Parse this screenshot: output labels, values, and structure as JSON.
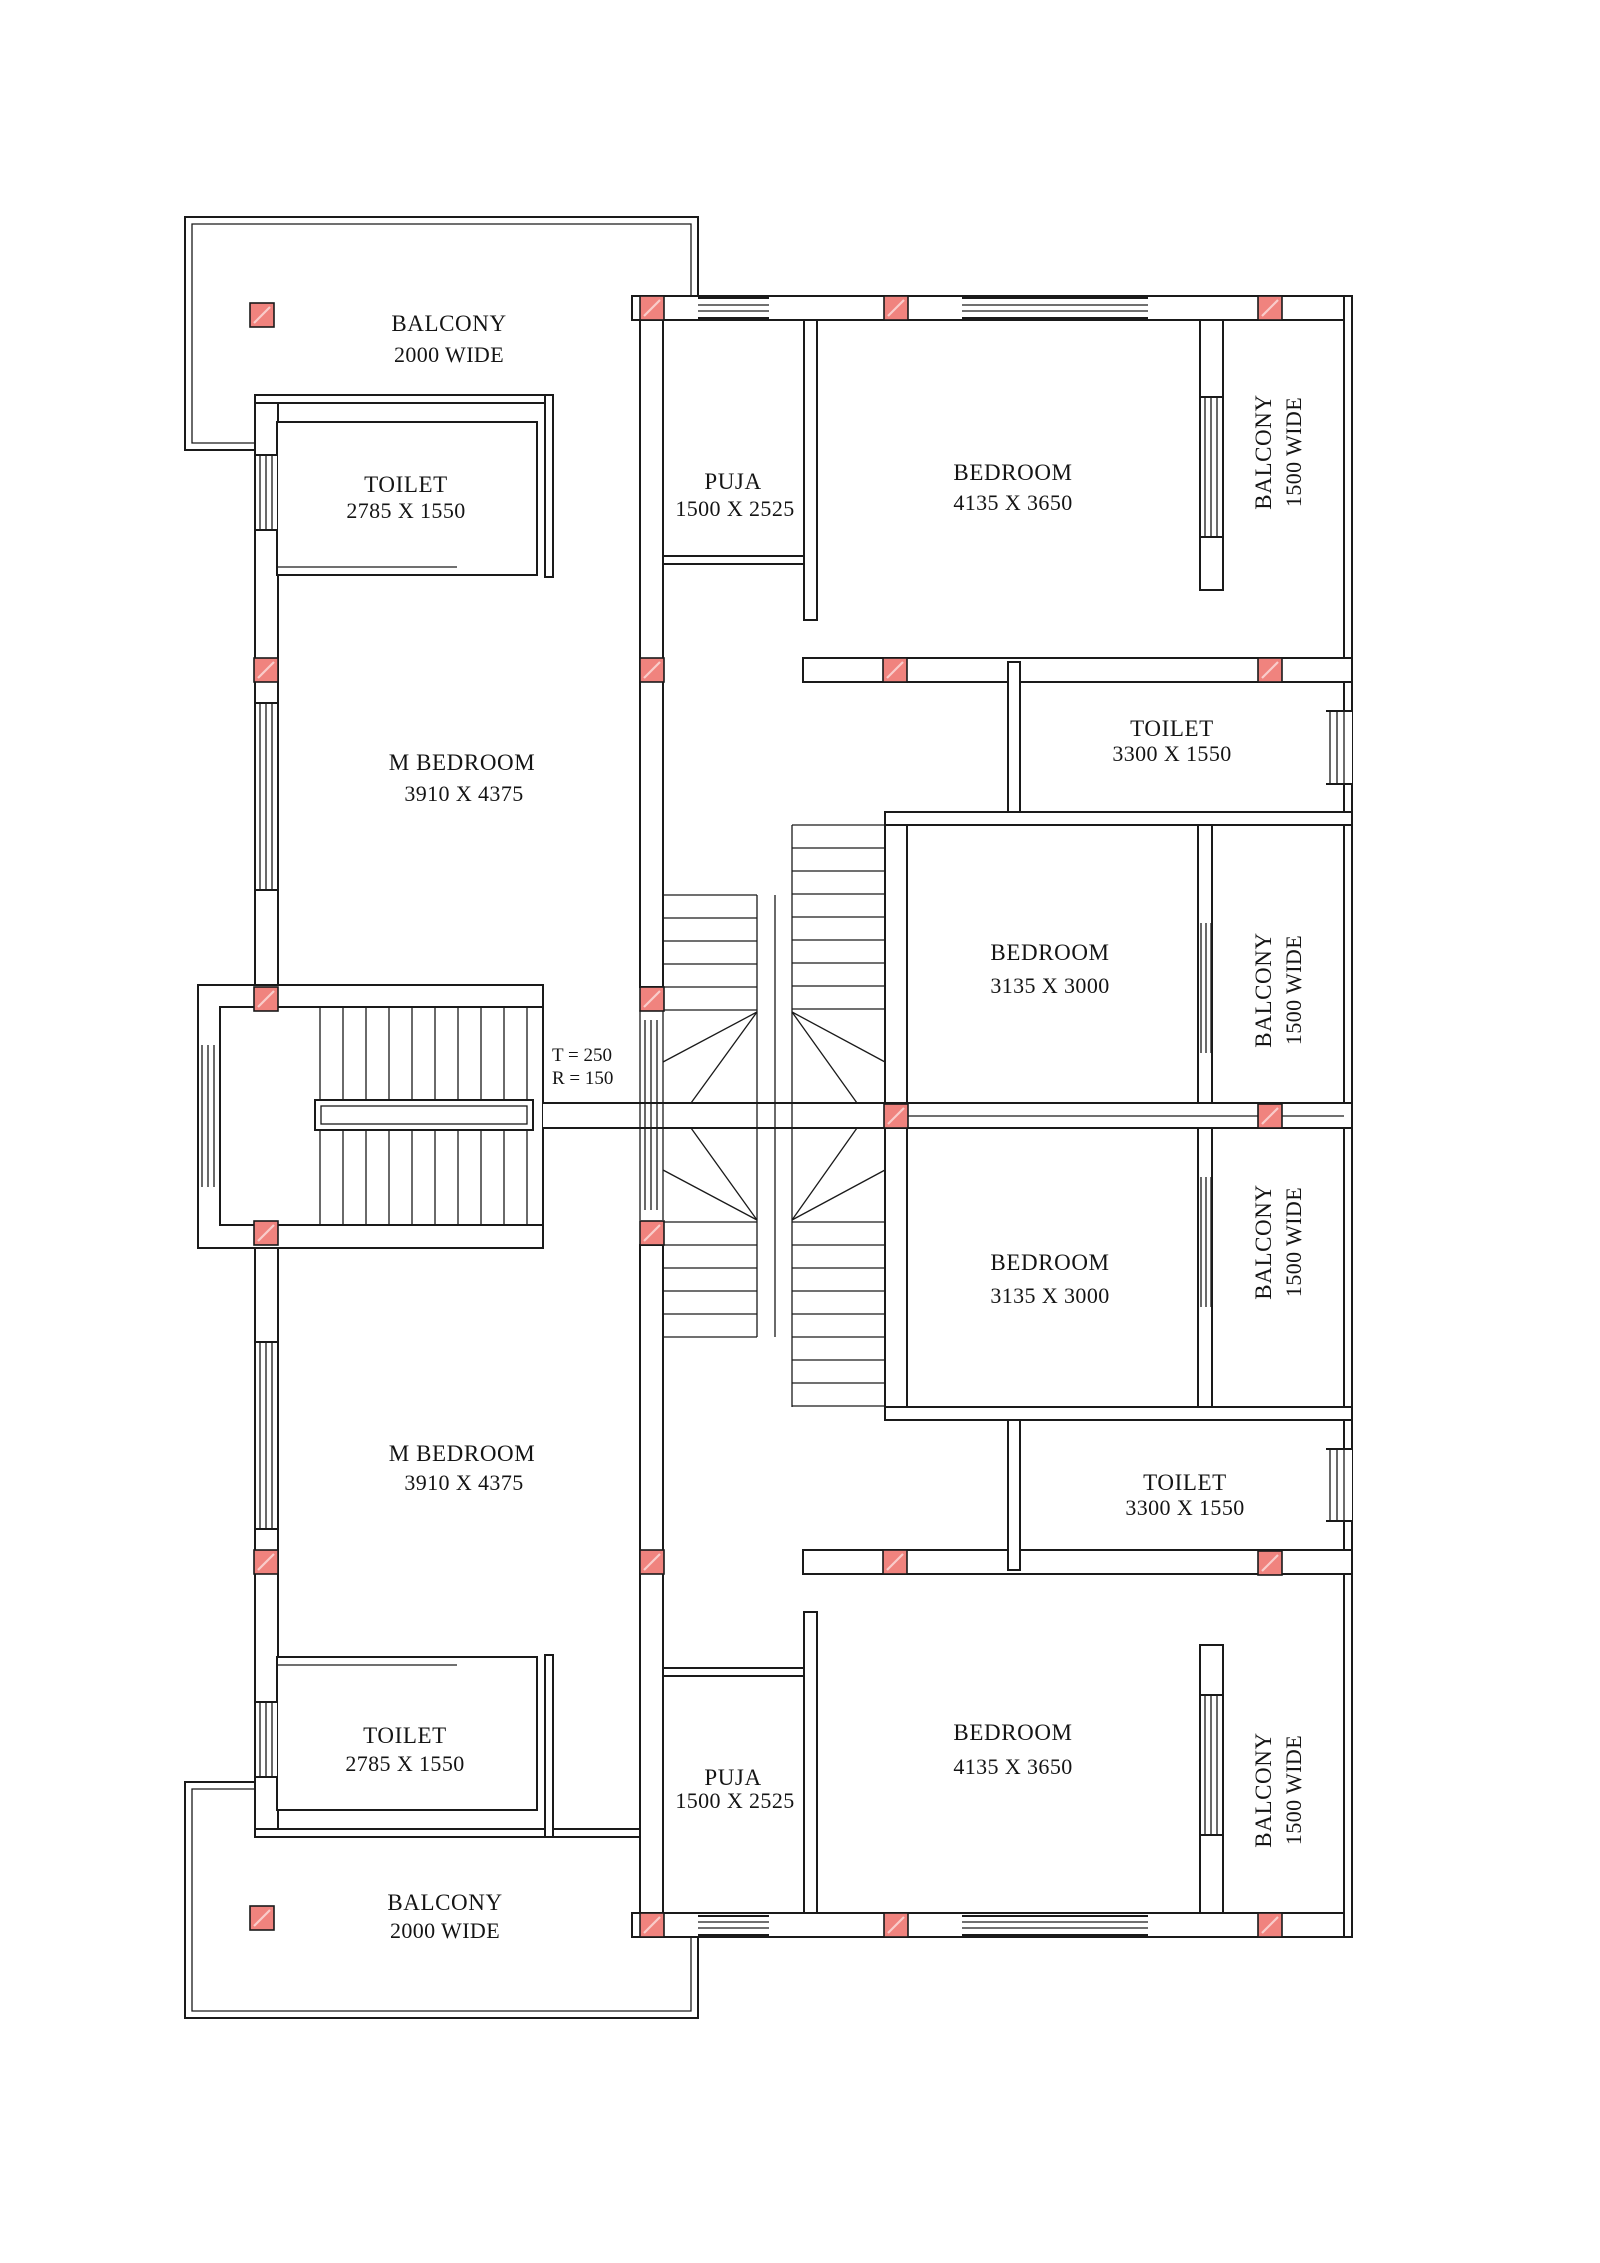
{
  "drawing": {
    "type": "floor-plan",
    "colors": {
      "line": "#1a1a1a",
      "column_fill": "#f0837e",
      "background": "#ffffff"
    }
  },
  "rooms": {
    "balcony_top_left": {
      "label": "BALCONY",
      "dims": "2000 WIDE"
    },
    "toilet_top_left": {
      "label": "TOILET",
      "dims": "2785 X 1550"
    },
    "puja_top": {
      "label": "PUJA",
      "dims": "1500 X 2525"
    },
    "bedroom_top_right": {
      "label": "BEDROOM",
      "dims": "4135 X 3650"
    },
    "balcony_top_right": {
      "label": "BALCONY",
      "dims": "1500 WIDE"
    },
    "m_bedroom_top": {
      "label": "M BEDROOM",
      "dims": "3910 X 4375"
    },
    "toilet_right_upper": {
      "label": "TOILET",
      "dims": "3300 X 1550"
    },
    "bedroom_mid_upper": {
      "label": "BEDROOM",
      "dims": "3135 X 3000"
    },
    "balcony_mid_upper": {
      "label": "BALCONY",
      "dims": "1500 WIDE"
    },
    "bedroom_mid_lower": {
      "label": "BEDROOM",
      "dims": "3135 X 3000"
    },
    "balcony_mid_lower": {
      "label": "BALCONY",
      "dims": "1500 WIDE"
    },
    "toilet_right_lower": {
      "label": "TOILET",
      "dims": "3300 X 1550"
    },
    "m_bedroom_bottom": {
      "label": "M BEDROOM",
      "dims": "3910 X 4375"
    },
    "bedroom_bottom_right": {
      "label": "BEDROOM",
      "dims": "4135 X 3650"
    },
    "balcony_bottom_right": {
      "label": "BALCONY",
      "dims": "1500 WIDE"
    },
    "puja_bottom": {
      "label": "PUJA",
      "dims": "1500 X 2525"
    },
    "toilet_bottom_left": {
      "label": "TOILET",
      "dims": "2785 X 1550"
    },
    "balcony_bottom_left": {
      "label": "BALCONY",
      "dims": "2000 WIDE"
    }
  },
  "stair": {
    "tread": "T = 250",
    "riser": "R = 150"
  }
}
